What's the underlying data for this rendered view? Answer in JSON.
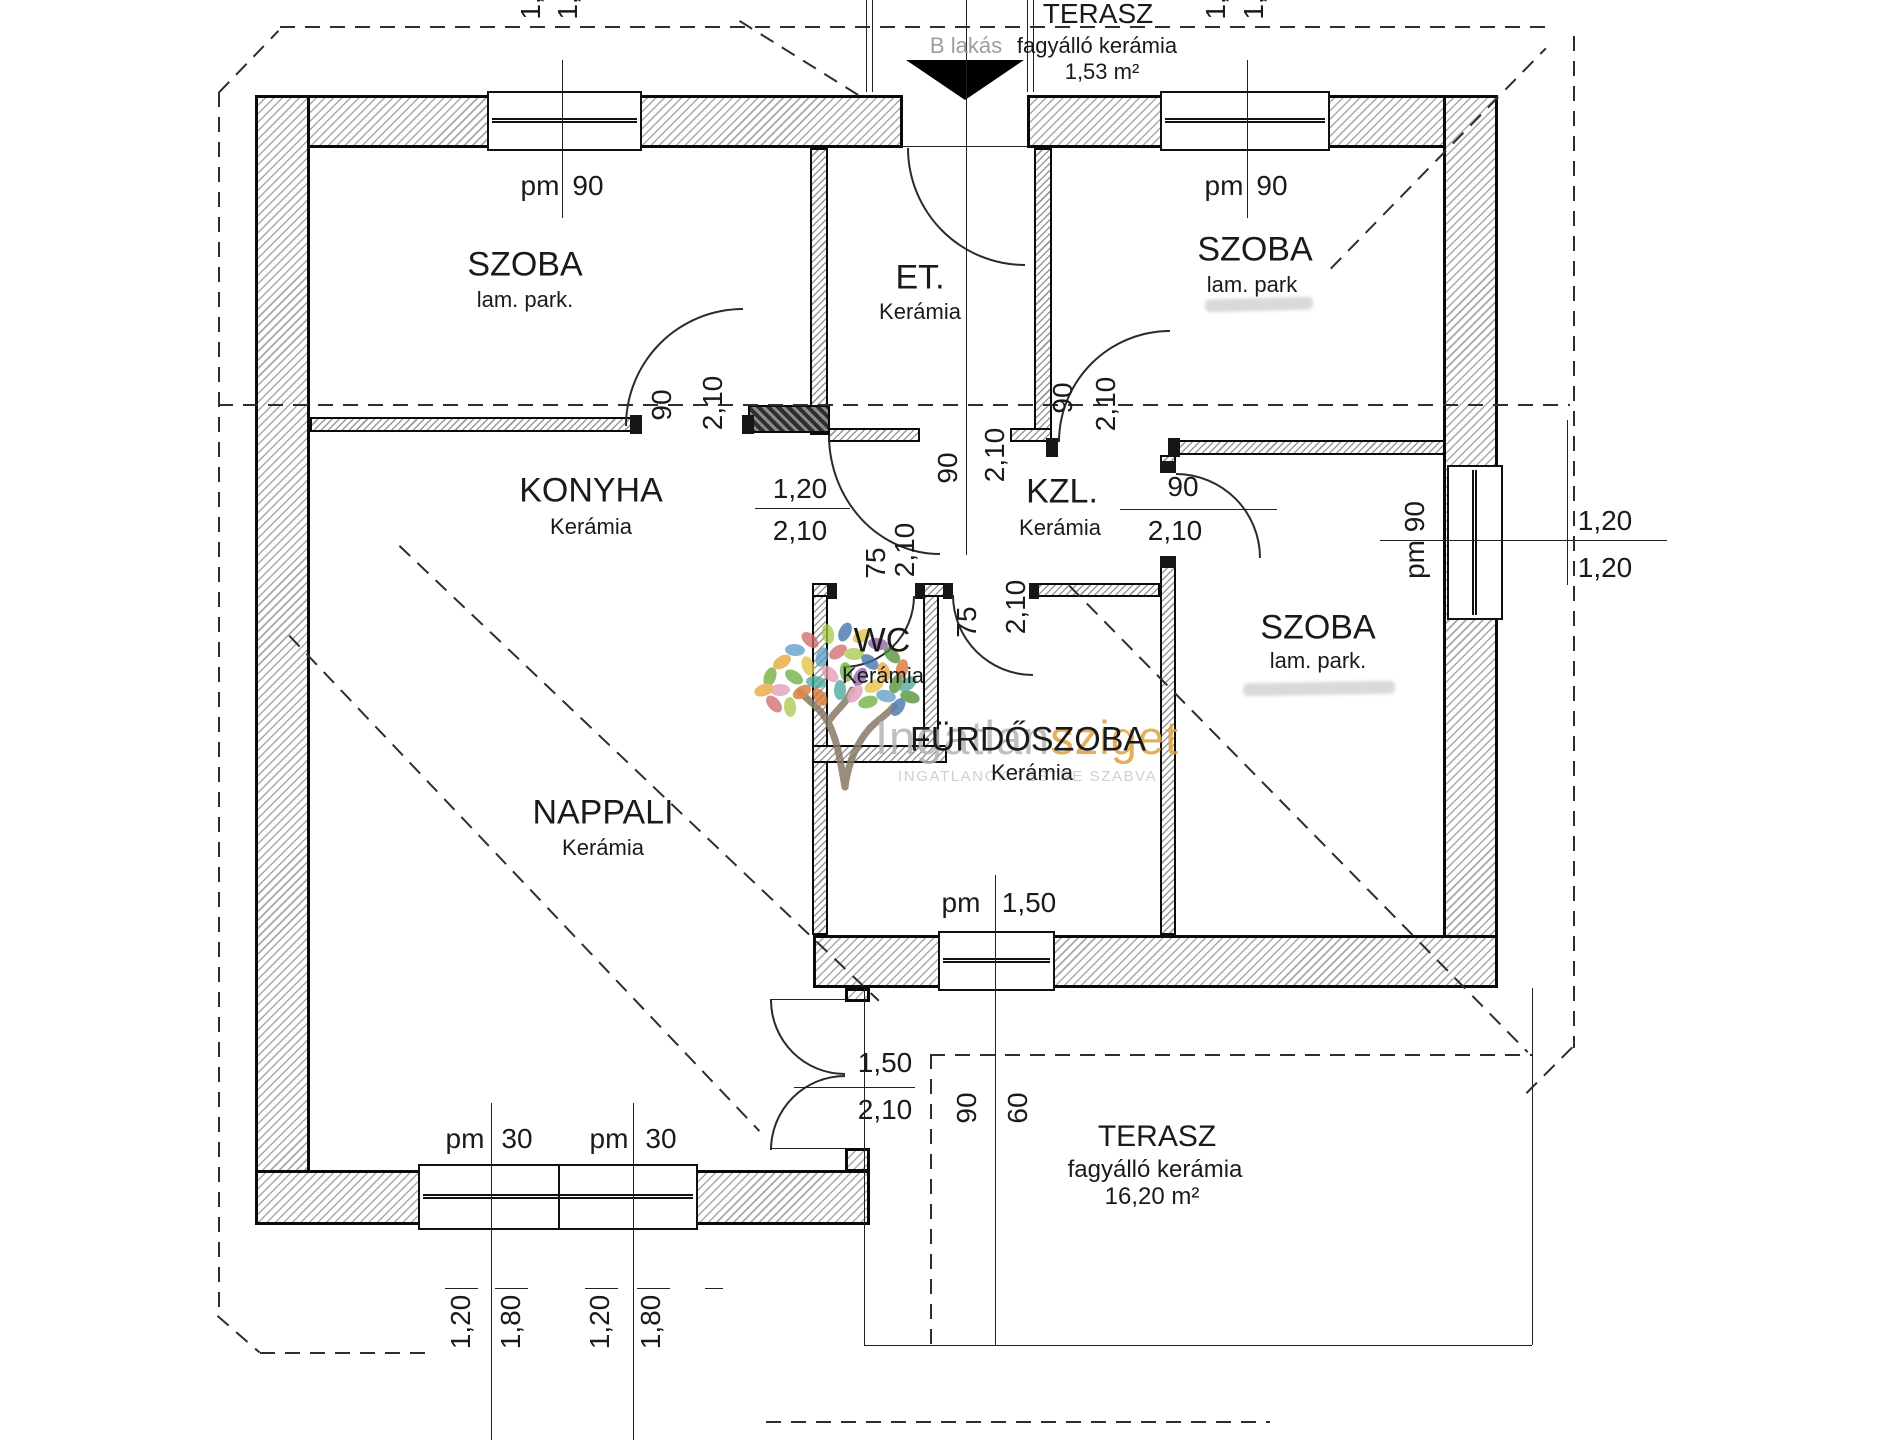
{
  "watermark": {
    "brand_primary": "Ingatlan",
    "brand_accent": "sziget",
    "tagline": "INGATLANOK TESTRE SZABVA",
    "accent_color": "#dfa23f",
    "gray_color": "#b5b5b5",
    "trunk_color": "#8a7a65",
    "leaf_colors": [
      "#6fae3e",
      "#4e8f35",
      "#a8c94e",
      "#e8a23b",
      "#d4742c",
      "#e4c23f",
      "#5f9ec7",
      "#3f6fa8",
      "#d16a6a",
      "#e09cb5",
      "#8a5fa8",
      "#49a89a"
    ]
  },
  "plan": {
    "unit_label": "B lakás",
    "rooms": [
      {
        "id": "szoba-tl",
        "name": "SZOBA",
        "floor": "lam. park."
      },
      {
        "id": "et",
        "name": "ET.",
        "floor": "Kerámia"
      },
      {
        "id": "szoba-tr",
        "name": "SZOBA",
        "floor": "lam. park"
      },
      {
        "id": "konyha",
        "name": "KONYHA",
        "floor": "Kerámia"
      },
      {
        "id": "kzl",
        "name": "KZL.",
        "floor": "Kerámia"
      },
      {
        "id": "wc",
        "name": "WC",
        "floor": "Kerámia"
      },
      {
        "id": "furdoszoba",
        "name": "FÜRDŐSZOBA",
        "floor": "Kerámia"
      },
      {
        "id": "szoba-r",
        "name": "SZOBA",
        "floor": "lam. park."
      },
      {
        "id": "nappali",
        "name": "NAPPALI",
        "floor": "Kerámia"
      },
      {
        "id": "terasz-top",
        "name": "TERASZ",
        "floor": "fagyálló kerámia",
        "area": "1,53 m²"
      },
      {
        "id": "terasz-bottom",
        "name": "TERASZ",
        "floor": "fagyálló kerámia",
        "area": "16,20 m²"
      }
    ],
    "dimensions": {
      "top-cut-1": "1,",
      "top-cut-2": "1,",
      "top-cut-3": "1,",
      "top-cut-4": "1,",
      "window-tl-pm": "pm",
      "window-tl-size": "90",
      "window-tr-pm": "pm",
      "window-tr-size": "90",
      "door-szoba-tl-width": "90",
      "door-szoba-tl-height": "2,10",
      "door-hall-width": "90",
      "door-hall-height": "2,10",
      "door-szoba-tr-width": "90",
      "door-szoba-tr-height": "2,10",
      "pass-konyha-width": "1,20",
      "pass-konyha-height": "2,10",
      "door-szoba-r-width": "90",
      "door-szoba-r-height": "2,10",
      "door-wc-width": "75",
      "door-wc-height": "2,10",
      "door-furdo-width": "75",
      "door-furdo-height": "2,10",
      "window-right-pm": "pm 90",
      "right-dim-upper": "1,20",
      "right-dim-lower": "1,20",
      "window-bottom-pm": "pm",
      "window-bottom-size": "1,50",
      "door-terasz-width": "1,50",
      "door-terasz-height": "2,10",
      "terasz-dim-90": "90",
      "terasz-dim-60": "60",
      "window-bl1-pm": "pm",
      "window-bl1-size": "30",
      "window-bl2-pm": "pm",
      "window-bl2-size": "30",
      "bottom-dim-1": "1,20",
      "bottom-dim-2": "1,80",
      "bottom-dim-3": "1,20",
      "bottom-dim-4": "1,80"
    }
  }
}
